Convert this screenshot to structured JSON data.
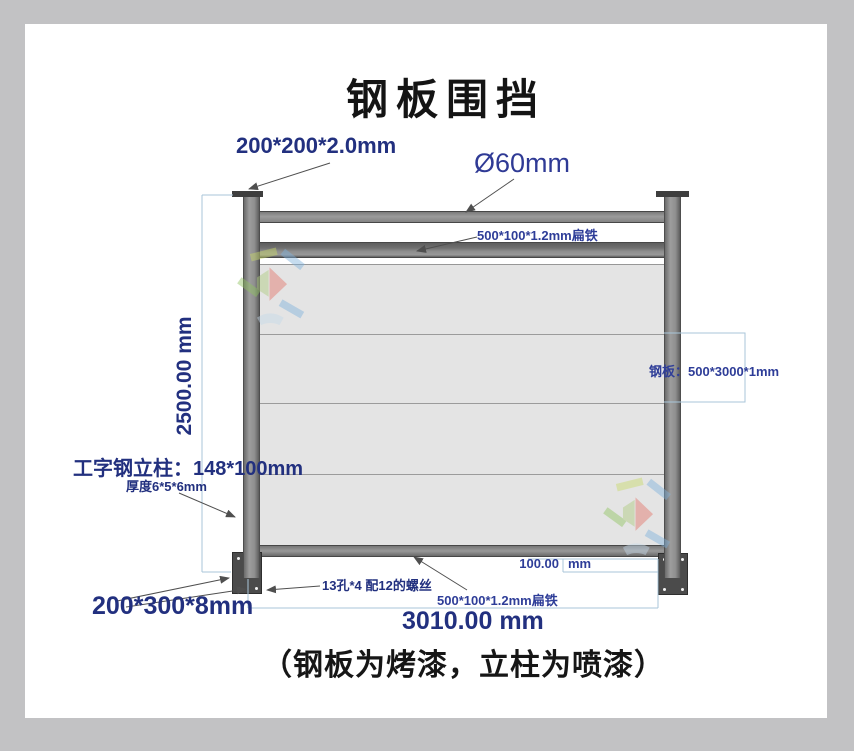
{
  "title": "钢板围挡",
  "footer_note": "（钢板为烤漆，立柱为喷漆）",
  "labels": {
    "cap_plate": "200*200*2.0mm",
    "pipe_diameter": "Ø60mm",
    "flat_iron_top": "500*100*1.2mm扁铁",
    "total_height": "2500.00 mm",
    "column_spec": "工字钢立柱：148*100mm",
    "column_thickness": "厚度6*5*6mm",
    "steel_panel": "钢板：500*3000*1mm",
    "ground_offset_value": "100.00",
    "ground_offset_unit": "mm",
    "bolt_holes": "13孔*4 配12的螺丝",
    "flat_iron_bottom": "500*100*1.2mm扁铁",
    "base_plate": "200*300*8mm",
    "total_width": "3010.00 mm"
  },
  "colors": {
    "label_navy": "#22307f",
    "label_blue": "#2e3d98",
    "dimension_line_blue": "#a8c6da",
    "leader_line_gray": "#4f4f4f",
    "steel_gray": "#8f8f8f",
    "panel_gray": "#e4e4e4",
    "plate_dark": "#4b4b4b",
    "frame_gray": "#c2c2c4"
  },
  "panel_count": 4
}
